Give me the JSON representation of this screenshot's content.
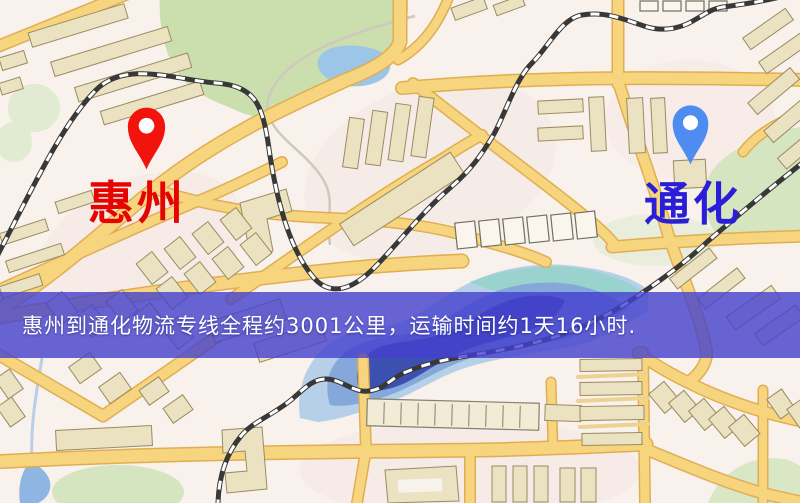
{
  "map": {
    "kind": "street-map",
    "origin": {
      "name": "惠州",
      "pin_icon": "red-map-pin",
      "pin_color": "#f2140c",
      "label_color": "#e60400"
    },
    "destination": {
      "name": "通化",
      "pin_icon": "blue-map-pin",
      "pin_color": "#4f8cf2",
      "label_color": "#2a1fd6"
    },
    "palette": {
      "background": "#f8f1ec",
      "road": "#f7d57f",
      "road_casing": "#e0ae52",
      "railway": "#383838",
      "water_light": "#b7d0ea",
      "water_mid": "#85a7da",
      "water_dark": "#3c50b2",
      "water_teal": "#9ad2cd",
      "park": "#cbdead",
      "building": "#ebe2c2"
    }
  },
  "banner": {
    "text": "惠州到通化物流专线全程约3001公里，运输时间约1天16小时.",
    "background": "#4340cd",
    "text_color": "#ffffff",
    "distance_km": 3001,
    "duration_text": "1天16小时"
  }
}
